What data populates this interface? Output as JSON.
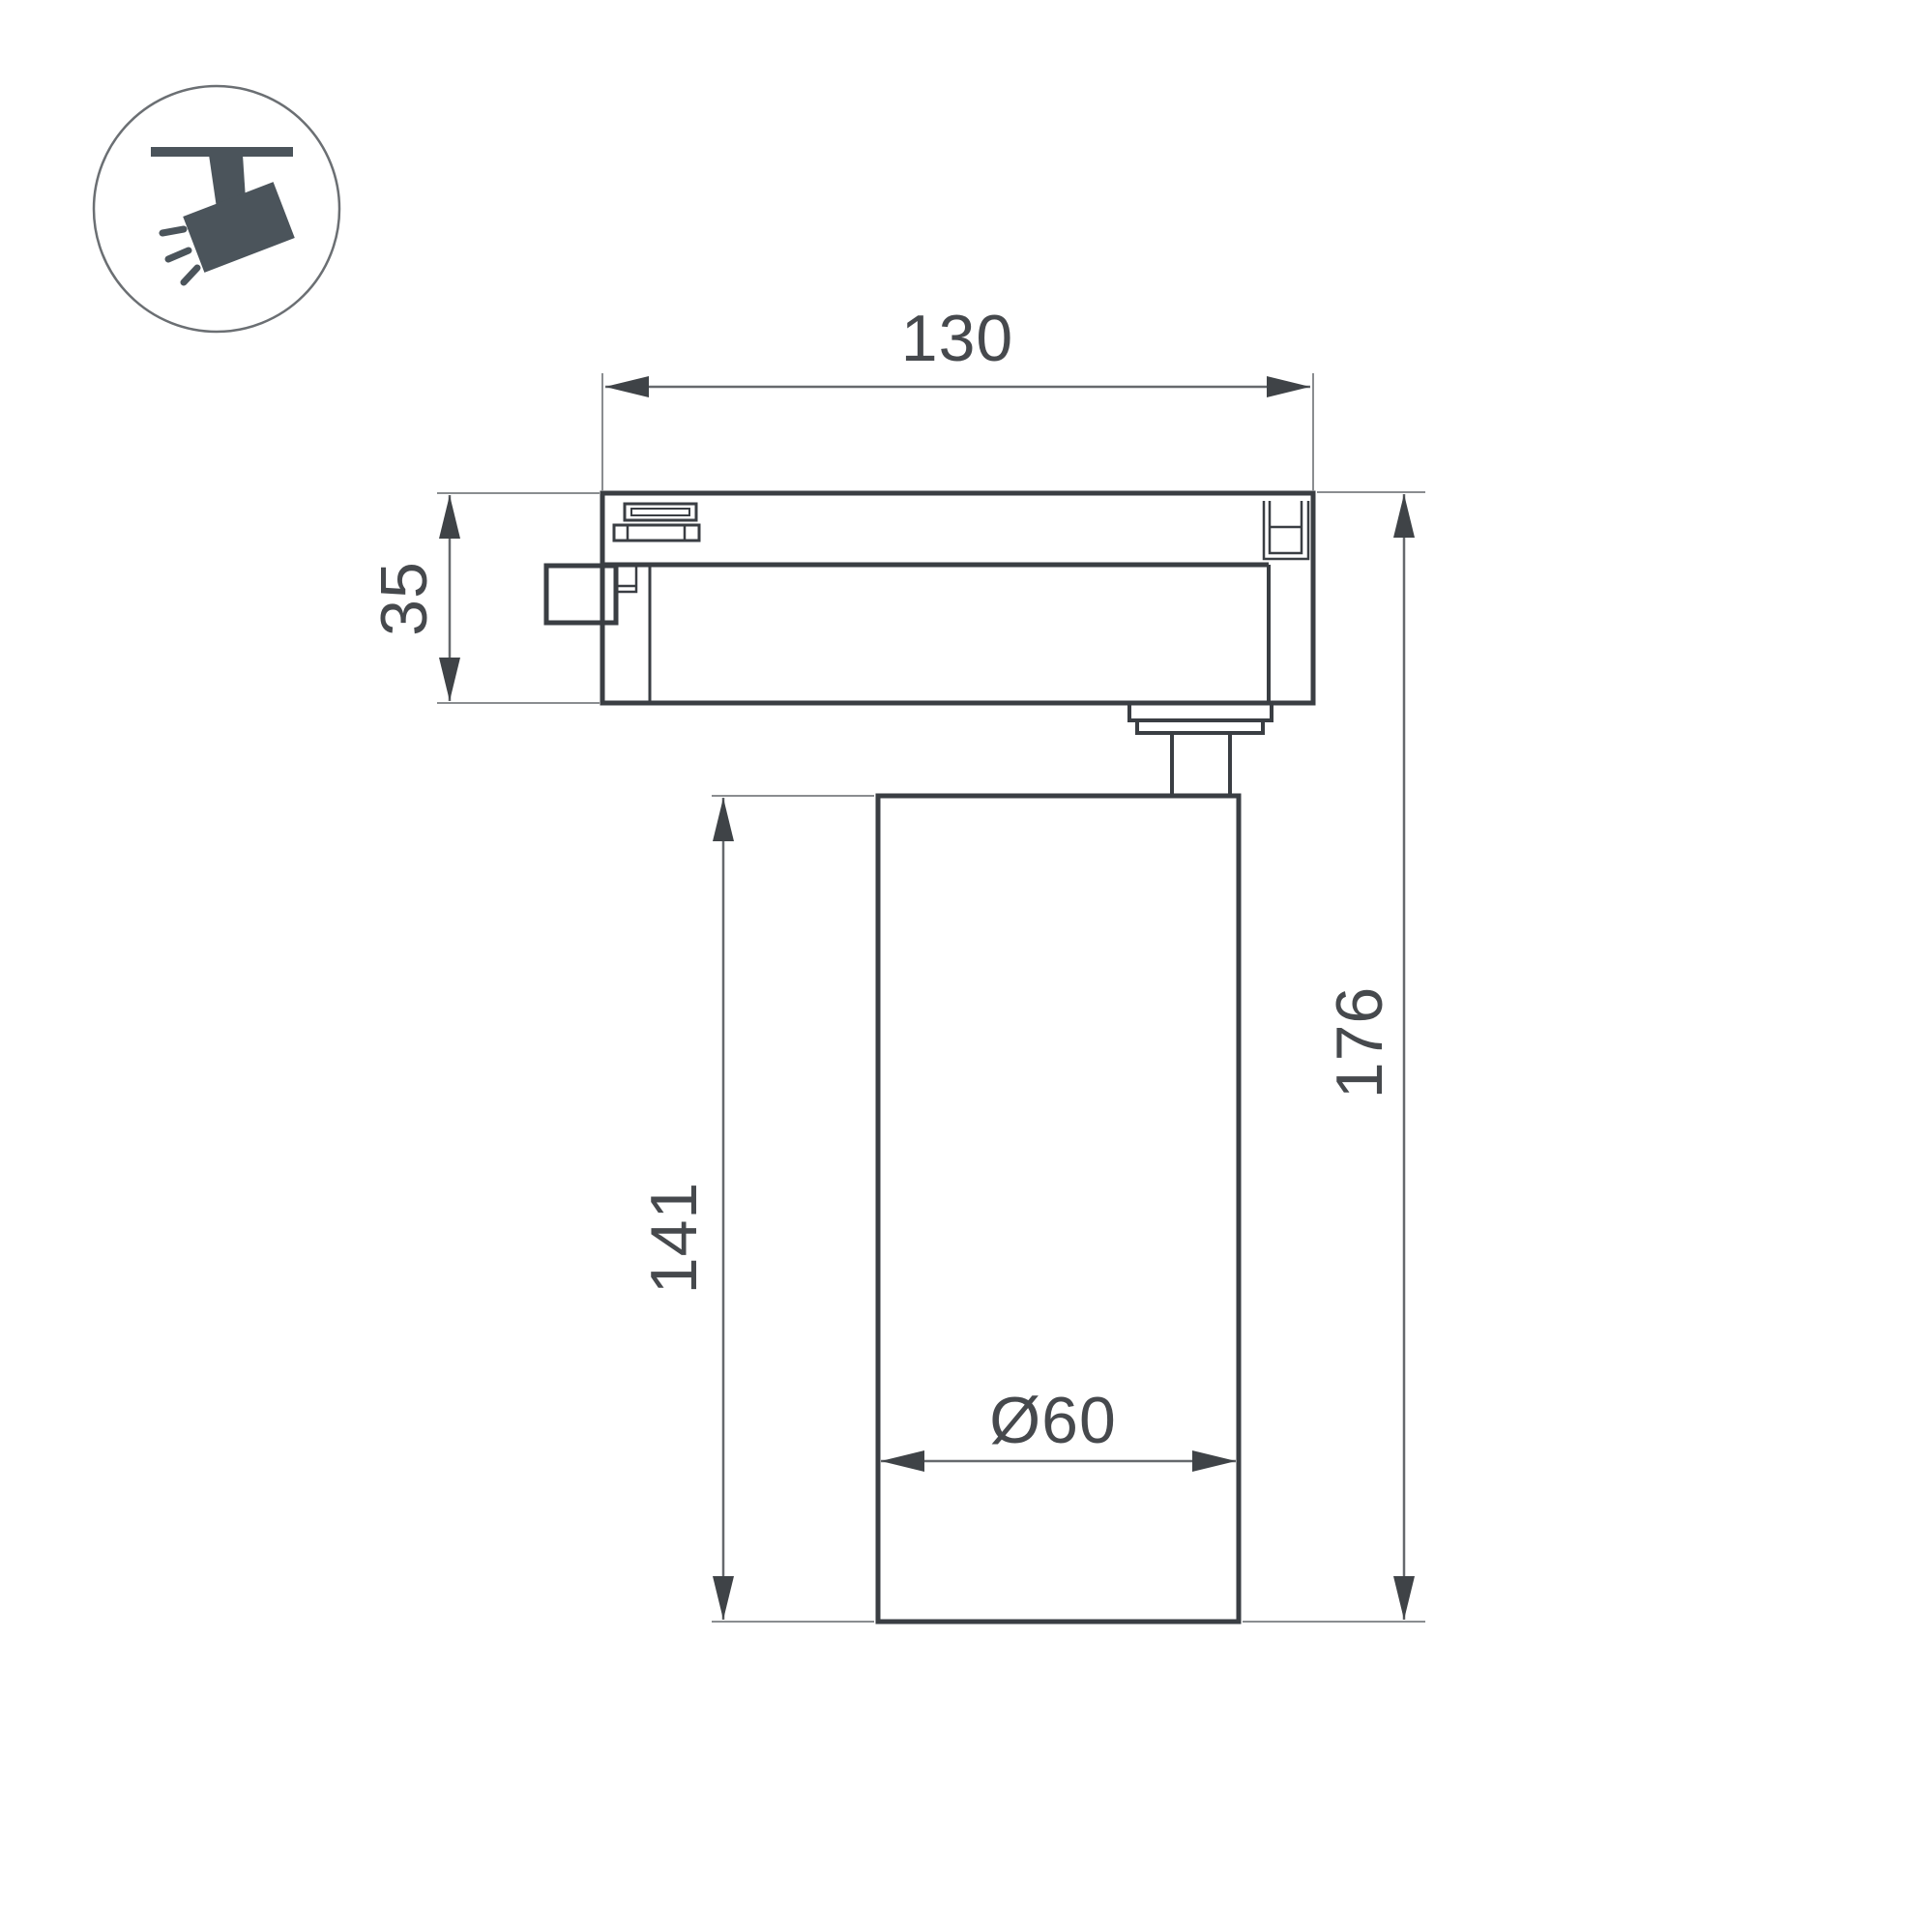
{
  "page": {
    "title": "Track spotlight dimensional drawing"
  },
  "icon": {
    "name": "track-spotlight-icon"
  },
  "dimensions": {
    "track_adapter_width": "130",
    "track_adapter_height": "35",
    "body_height": "141",
    "overall_height": "176",
    "body_diameter": "Ø60"
  },
  "colors": {
    "background": "#ffffff",
    "outline": "#3a3e43",
    "dimension_line": "#66696d",
    "extension_line": "#8a8d90",
    "arrow": "#3f4347",
    "label_text": "#46494d",
    "icon_fill": "#4b545b",
    "icon_circle_stroke": "#6b6f73"
  }
}
